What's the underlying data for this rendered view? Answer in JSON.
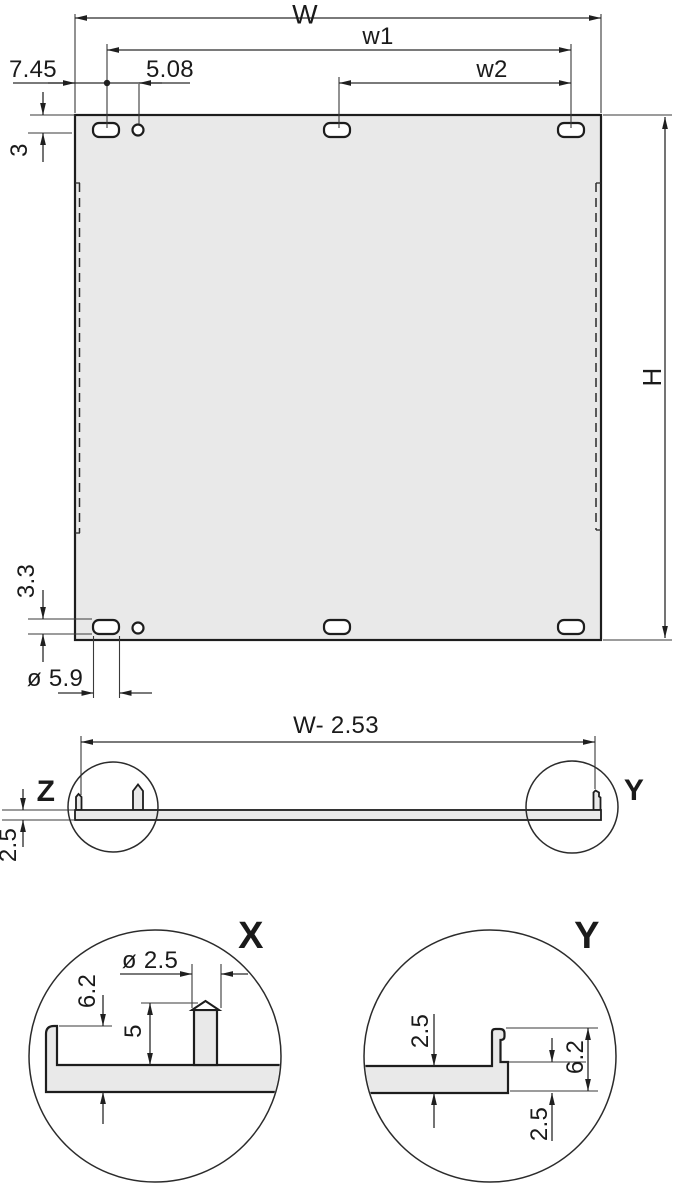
{
  "colors": {
    "panel_fill": "#e9e9e9",
    "line": "#1d1d1d",
    "background": "#ffffff"
  },
  "front_view": {
    "dim_width": "W",
    "dim_w1": "w1",
    "dim_w2": "w2",
    "dim_edge_offset": "7.45",
    "dim_hole_offset": "5.08",
    "dim_top_inset": "3",
    "dim_bottom_inset": "3.3",
    "dim_slot_width": "ø 5.9",
    "dim_height": "H"
  },
  "profile_view": {
    "dim_width": "W- 2.53",
    "dim_thickness": "2.5",
    "detail_marker_z": "Z",
    "detail_marker_y": "Y"
  },
  "detail_x": {
    "label": "X",
    "dim_pin_diameter": "ø 2.5",
    "dim_overall_height": "6.2",
    "dim_pin_height": "5"
  },
  "detail_y": {
    "label": "Y",
    "dim_plate_thickness": "2.5",
    "dim_overall_height": "6.2",
    "dim_lip_offset": "2.5"
  }
}
